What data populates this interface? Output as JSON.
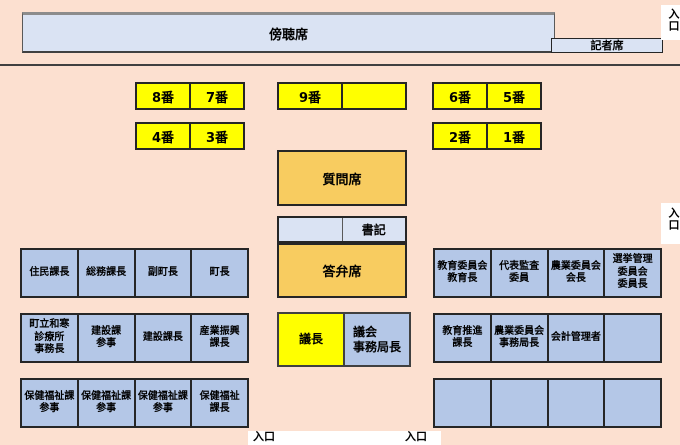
{
  "colors": {
    "background": "#FCE0D0",
    "panel_blue": "#DAE3F3",
    "seat_blue": "#B4C7E7",
    "seat_yellow": "#FFFF00",
    "seat_amber": "#F8CC60"
  },
  "gallery_label": "傍聴席",
  "press_label": "記者席",
  "entrance_label": "入口",
  "member_seats": {
    "r1p1": [
      "8番",
      "7番"
    ],
    "r1p2": [
      "9番",
      ""
    ],
    "r1p3": [
      "6番",
      "5番"
    ],
    "r2p1": [
      "4番",
      "3番"
    ],
    "r2p2": [
      "2番",
      "1番"
    ]
  },
  "center": {
    "question_seat": "質問席",
    "clerk": "書記",
    "answer_seat": "答弁席",
    "chair": "議長",
    "council_secretary": "議会\n事務局長"
  },
  "officials_left": {
    "row1": [
      "住民課長",
      "総務課長",
      "副町長",
      "町長"
    ],
    "row2": [
      "町立和寒\n診療所\n事務長",
      "建設課\n参事",
      "建設課長",
      "産業振興\n課長"
    ],
    "row3": [
      "保健福祉課\n参事",
      "保健福祉課\n参事",
      "保健福祉課\n参事",
      "保健福祉\n課長"
    ]
  },
  "officials_right": {
    "row1": [
      "教育委員会\n教育長",
      "代表監査\n委員",
      "農業委員会\n会長",
      "選挙管理\n委員会\n委員長"
    ],
    "row2": [
      "教育推進\n課長",
      "農業委員会\n事務局長",
      "会計管理者",
      ""
    ],
    "row3": [
      "",
      "",
      "",
      ""
    ]
  }
}
